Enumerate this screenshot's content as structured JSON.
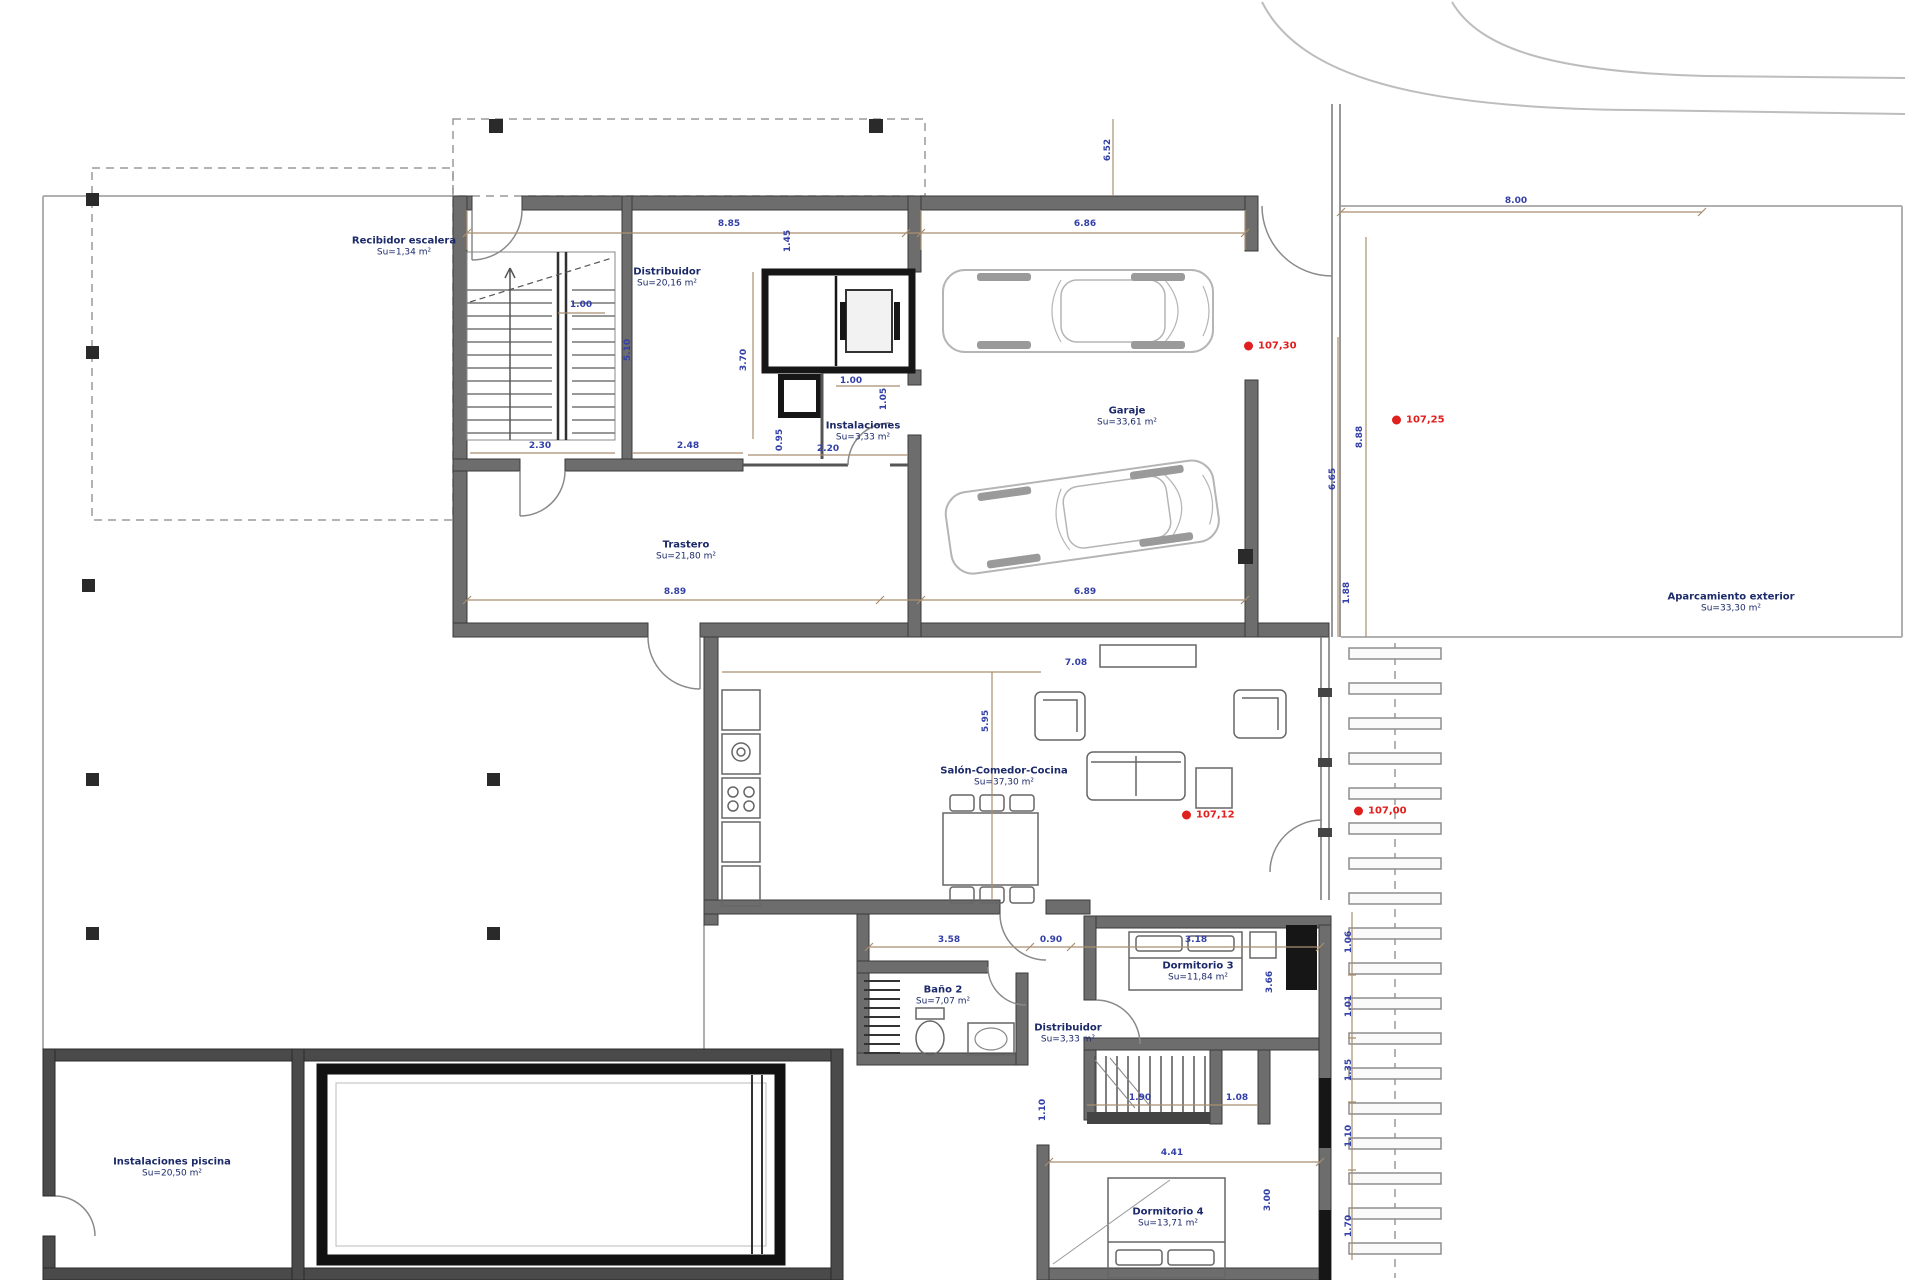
{
  "drawing": {
    "type": "architectural floor plan"
  },
  "colors": {
    "wall": "#6d6d6d",
    "wall_dark": "#161616",
    "pool_wall": "#4a4a4a",
    "light_line": "#bdbdbd",
    "dim_line": "#a98e6f",
    "dim_text": "#3340a8",
    "room_text": "#1c2a6a",
    "level_red": "#e01f1f"
  },
  "rooms": {
    "recibidor": {
      "name": "Recibidor escalera",
      "area": "Su=1,34 m²"
    },
    "distribuidor1": {
      "name": "Distribuidor",
      "area": "Su=20,16 m²"
    },
    "instalaciones": {
      "name": "Instalaciones",
      "area": "Su=3,33 m²"
    },
    "trastero": {
      "name": "Trastero",
      "area": "Su=21,80 m²"
    },
    "garaje": {
      "name": "Garaje",
      "area": "Su=33,61 m²"
    },
    "aparcamiento": {
      "name": "Aparcamiento exterior",
      "area": "Su=33,30 m²"
    },
    "salon": {
      "name": "Salón-Comedor-Cocina",
      "area": "Su=37,30 m²"
    },
    "bano2": {
      "name": "Baño 2",
      "area": "Su=7,07 m²"
    },
    "distribuidor2": {
      "name": "Distribuidor",
      "area": "Su=3,33 m²"
    },
    "dormitorio3": {
      "name": "Dormitorio 3",
      "area": "Su=11,84 m²"
    },
    "dormitorio4": {
      "name": "Dormitorio 4",
      "area": "Su=13,71 m²"
    },
    "piscina": {
      "name": "Instalaciones piscina",
      "area": "Su=20,50 m²"
    }
  },
  "levels": [
    {
      "value": "107,30"
    },
    {
      "value": "107,25"
    },
    {
      "value": "107,12"
    },
    {
      "value": "107,00"
    }
  ],
  "dims": {
    "top_left": "8.85",
    "top_right": "6.86",
    "bottom_left": "8.89",
    "bottom_right": "6.89",
    "v_145": "1.45",
    "stair_w": "1.00",
    "stair_h": "5.10",
    "v_370": "3.70",
    "elev_w": "1.00",
    "v_105": "1.05",
    "v_095": "0.95",
    "w_230": "2.30",
    "w_248": "2.48",
    "w_220": "2.20",
    "gate_v": "6.52",
    "right_665": "6.65",
    "right_888": "8.88",
    "right_188": "1.88",
    "drive_w": "8.00",
    "salon_w": "7.08",
    "salon_h": "5.95",
    "bed_a": "3.58",
    "bed_b": "0.90",
    "bed_c": "3.18",
    "d3_h": "3.66",
    "st2_a": "1.90",
    "st2_b": "1.08",
    "d4_w": "4.41",
    "d4_h": "3.00",
    "d4_l": "1.10",
    "chain_1": "1.06",
    "chain_2": "1.01",
    "chain_3": "1.35",
    "chain_4": "1.10",
    "chain_5": "1.70"
  }
}
